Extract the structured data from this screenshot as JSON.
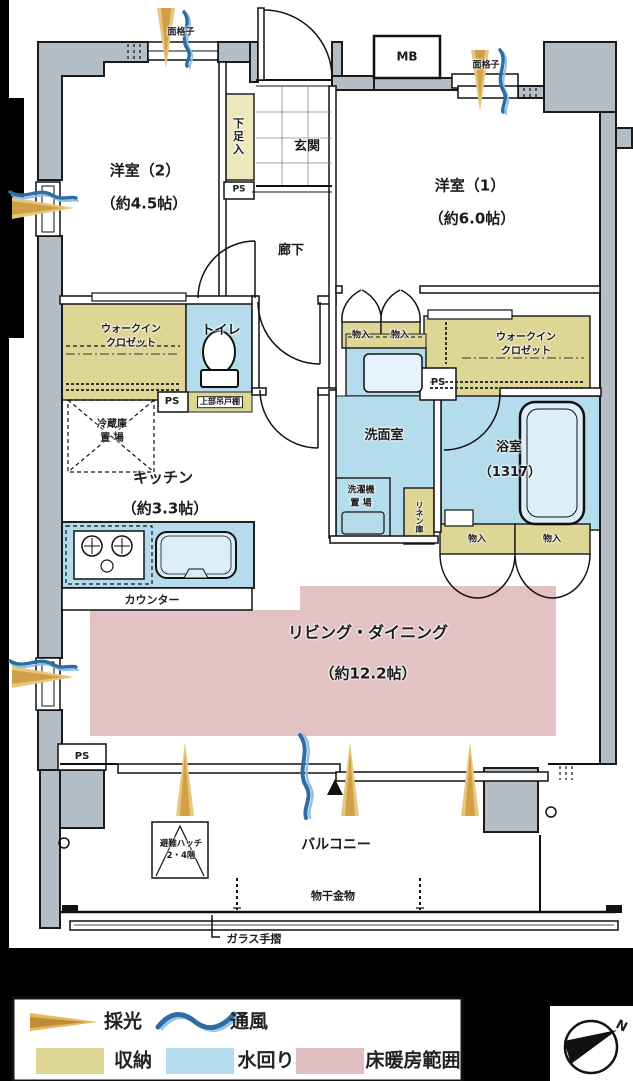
{
  "rooms": {
    "western2": {
      "name": "洋室（2）",
      "area": "（約4.5帖）"
    },
    "western1": {
      "name": "洋室（1）",
      "area": "（約6.0帖）"
    },
    "entrance": {
      "name": "玄関"
    },
    "hallway": {
      "name": "廊下"
    },
    "toilet": {
      "name": "トイレ"
    },
    "wic": {
      "name": "ウォークイン\nクロゼット"
    },
    "kitchen": {
      "name": "キッチン",
      "area": "（約3.3帖）"
    },
    "washroom": {
      "name": "洗面室"
    },
    "bathroom": {
      "name": "浴室",
      "area": "（1317）"
    },
    "living": {
      "name": "リビング・ダイニング",
      "area": "（約12.2帖）"
    },
    "balcony": {
      "name": "バルコニー"
    }
  },
  "labels": {
    "mb": "MB",
    "ps": "PS",
    "lattice": "面格子",
    "shoe_cabinet": "下足入",
    "upper_cabinet": "上部吊戸棚",
    "fridge_space": "冷蔵庫\n置 場",
    "counter": "カウンター",
    "washer_space": "洗濯機\n置 場",
    "linen": "リネン庫",
    "storage": "物入",
    "hatch": "避難ハッチ\n2・4階",
    "drying_hardware": "物干金物",
    "glass_rail": "ガラス手摺",
    "north": "N"
  },
  "legend": {
    "daylight": "採光",
    "airflow": "通風",
    "storage": "収納",
    "water": "水回り",
    "floor_heating": "床暖房範囲"
  },
  "colors": {
    "storage": "#ded695",
    "water": "#b5dcec",
    "floor_heating": "#e2c2c2",
    "wall": "#b4bec6",
    "daylight": "#d9a947",
    "airflow": "#2e6da4"
  }
}
